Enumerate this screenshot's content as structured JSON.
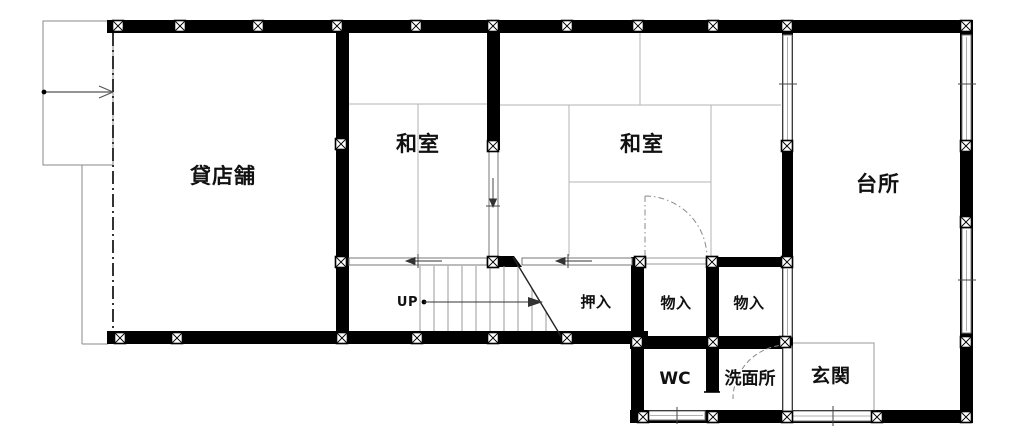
{
  "plan": {
    "type": "floor-plan",
    "floor_label_direction": "UP",
    "rooms": {
      "store": {
        "label": "貸店舗"
      },
      "washitsu_left": {
        "label": "和室"
      },
      "washitsu_right": {
        "label": "和室"
      },
      "kitchen": {
        "label": "台所"
      },
      "closet": {
        "label": "押入"
      },
      "storage_left": {
        "label": "物入"
      },
      "storage_right": {
        "label": "物入"
      },
      "wc": {
        "label": "WC"
      },
      "washroom": {
        "label": "洗面所"
      },
      "entrance": {
        "label": "玄関"
      }
    },
    "stairs": {
      "label": "UP"
    },
    "colors": {
      "wall": "#000000",
      "thin_line": "#888888",
      "tatami_line": "#b3b3b3",
      "background": "#ffffff"
    }
  }
}
